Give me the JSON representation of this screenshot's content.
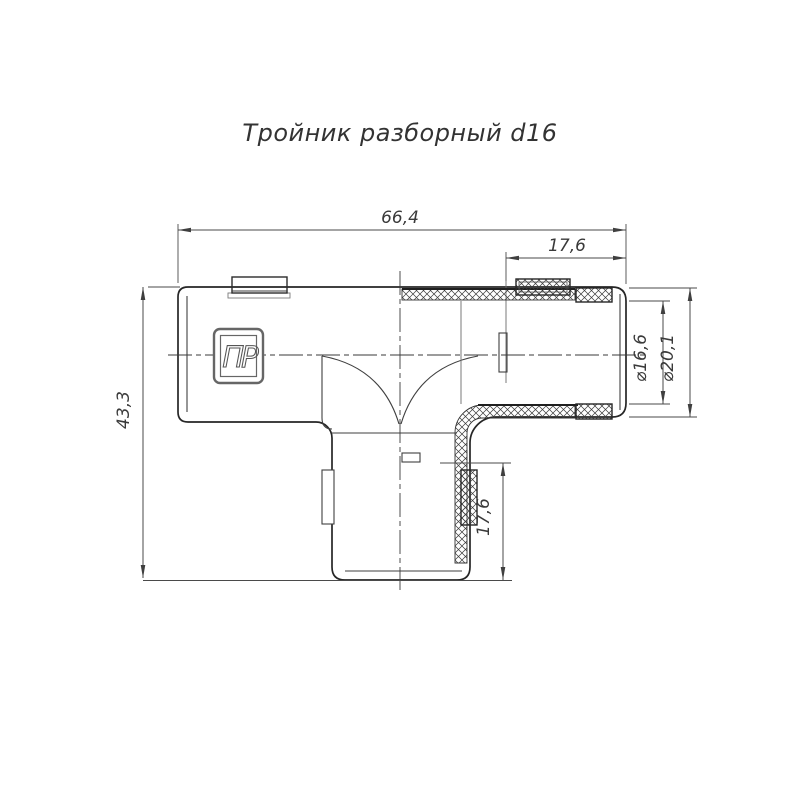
{
  "title": "Тройник разборный d16",
  "drawing": {
    "type": "technical-drawing",
    "part_name": "Тройник разборный",
    "nominal_size": "d16",
    "logo_text": "ПР",
    "dimensions": {
      "overall_width": "66,4",
      "top_socket_depth": "17,6",
      "overall_height": "43,3",
      "bore_diameter": "⌀16,6",
      "pipe_diameter": "⌀20,1",
      "bottom_socket_depth": "17,6"
    },
    "colors": {
      "outline": "#262626",
      "thin_line": "#3f3f3f",
      "dimension_line": "#4a4a4a",
      "background": "#ffffff"
    }
  }
}
